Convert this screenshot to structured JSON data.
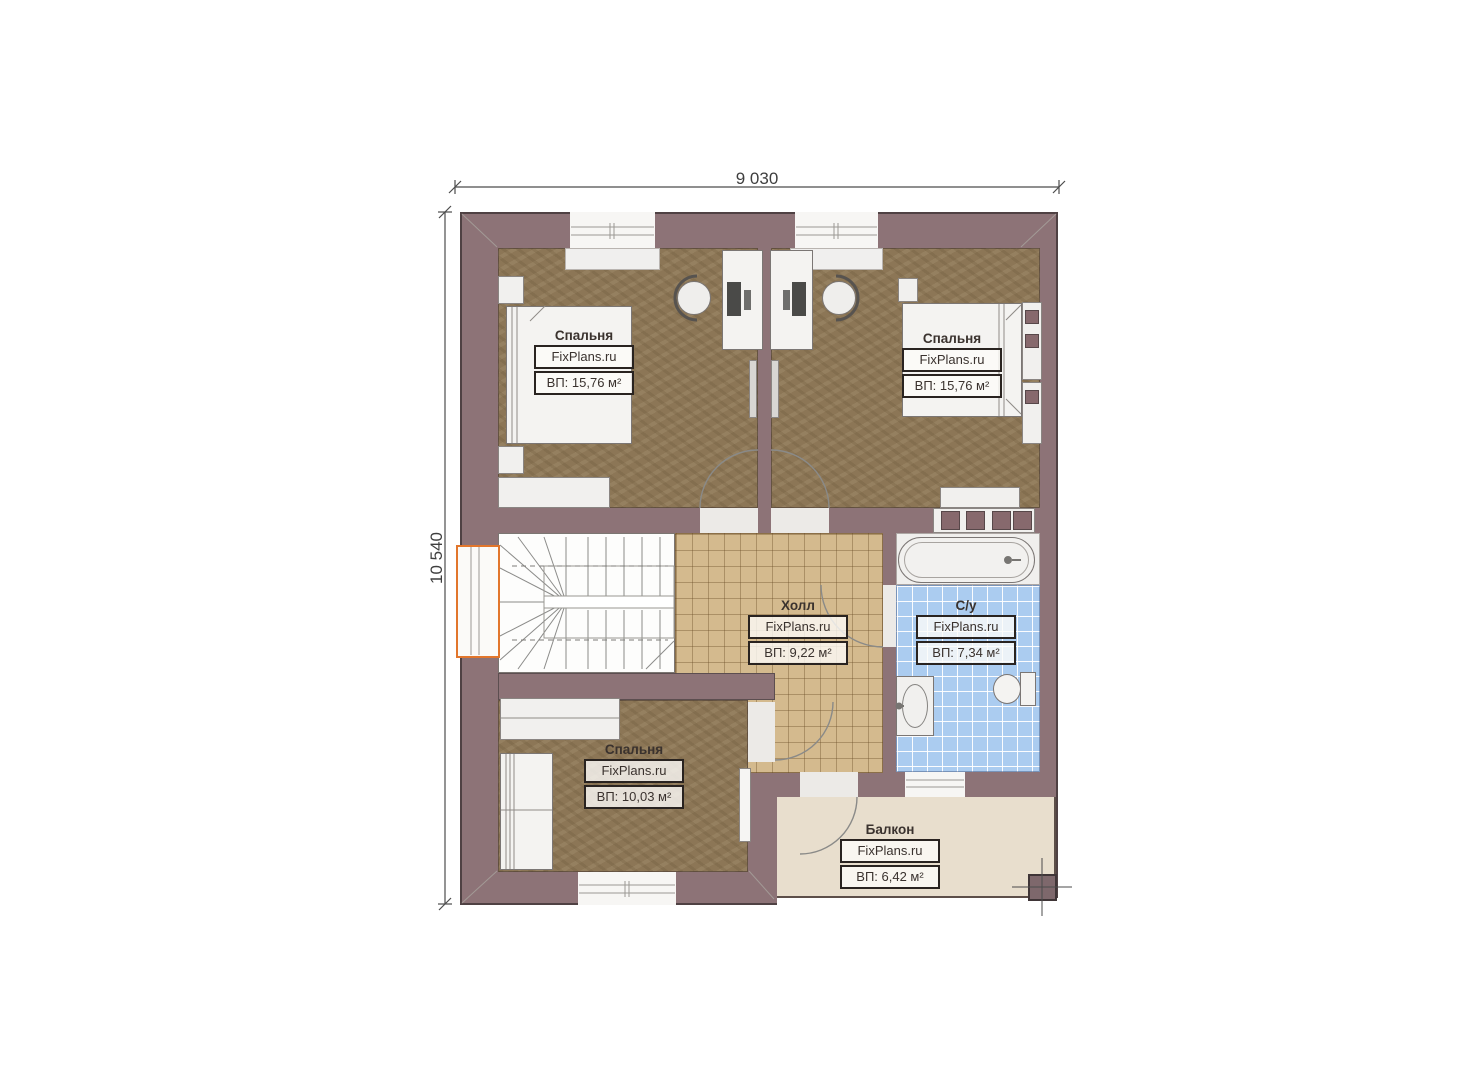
{
  "plan": {
    "dimensions": {
      "width": "9 030",
      "height": "10 540"
    },
    "watermark": "FixPlans.ru",
    "rooms": [
      {
        "key": "bedroom-top-left",
        "name": "Спальня",
        "area": "ВП: 15,76 м²"
      },
      {
        "key": "bedroom-top-right",
        "name": "Спальня",
        "area": "ВП: 15,76 м²"
      },
      {
        "key": "hall",
        "name": "Холл",
        "area": "ВП: 9,22 м²"
      },
      {
        "key": "bathroom",
        "name": "С/у",
        "area": "ВП: 7,34 м²"
      },
      {
        "key": "bedroom-bottom",
        "name": "Спальня",
        "area": "ВП: 10,03 м²"
      },
      {
        "key": "balcony",
        "name": "Балкон",
        "area": "ВП: 6,42 м²"
      }
    ],
    "colors": {
      "wall": "#8d7377",
      "wood_floor": "#8c7656",
      "hall_tile": "#d4ba8e",
      "bath_tile": "#abccf0",
      "balcony_floor": "#e8decd",
      "window_highlight": "#e2762c"
    }
  }
}
